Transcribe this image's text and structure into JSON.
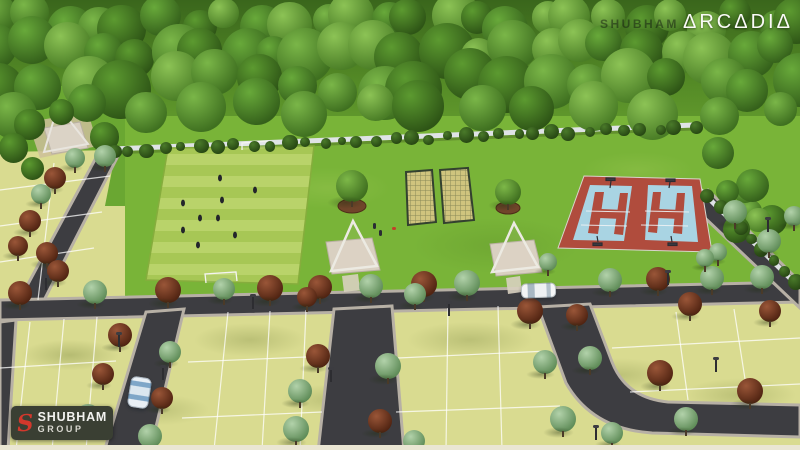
{
  "branding": {
    "project_logo_text": "ΔRCΔDIΔ",
    "project_watermark_text": "SHUBHAM",
    "developer_icon_glyph": "S",
    "developer_name": "SHUBHAM",
    "developer_suffix": "GROUP"
  },
  "colors": {
    "forest_light": "#6aa331",
    "park_grass": "#79b438",
    "field_stripe_a": "#b9d36a",
    "field_stripe_b": "#a7c755",
    "plot_ground": "#d9db90",
    "road_asphalt": "#3d3d41",
    "road_curb": "#b7b0a5",
    "court_blue": "#a9d4e3",
    "court_red": "#b04c3d",
    "wall_light": "#dfe3e6",
    "pergola_pad": "#d9d0c1",
    "net_floor": "#cfc47e",
    "logo_badge_bg": "#3a3f33",
    "logo_accent_red": "#d2382c",
    "logo_text": "#f2f2ef"
  }
}
